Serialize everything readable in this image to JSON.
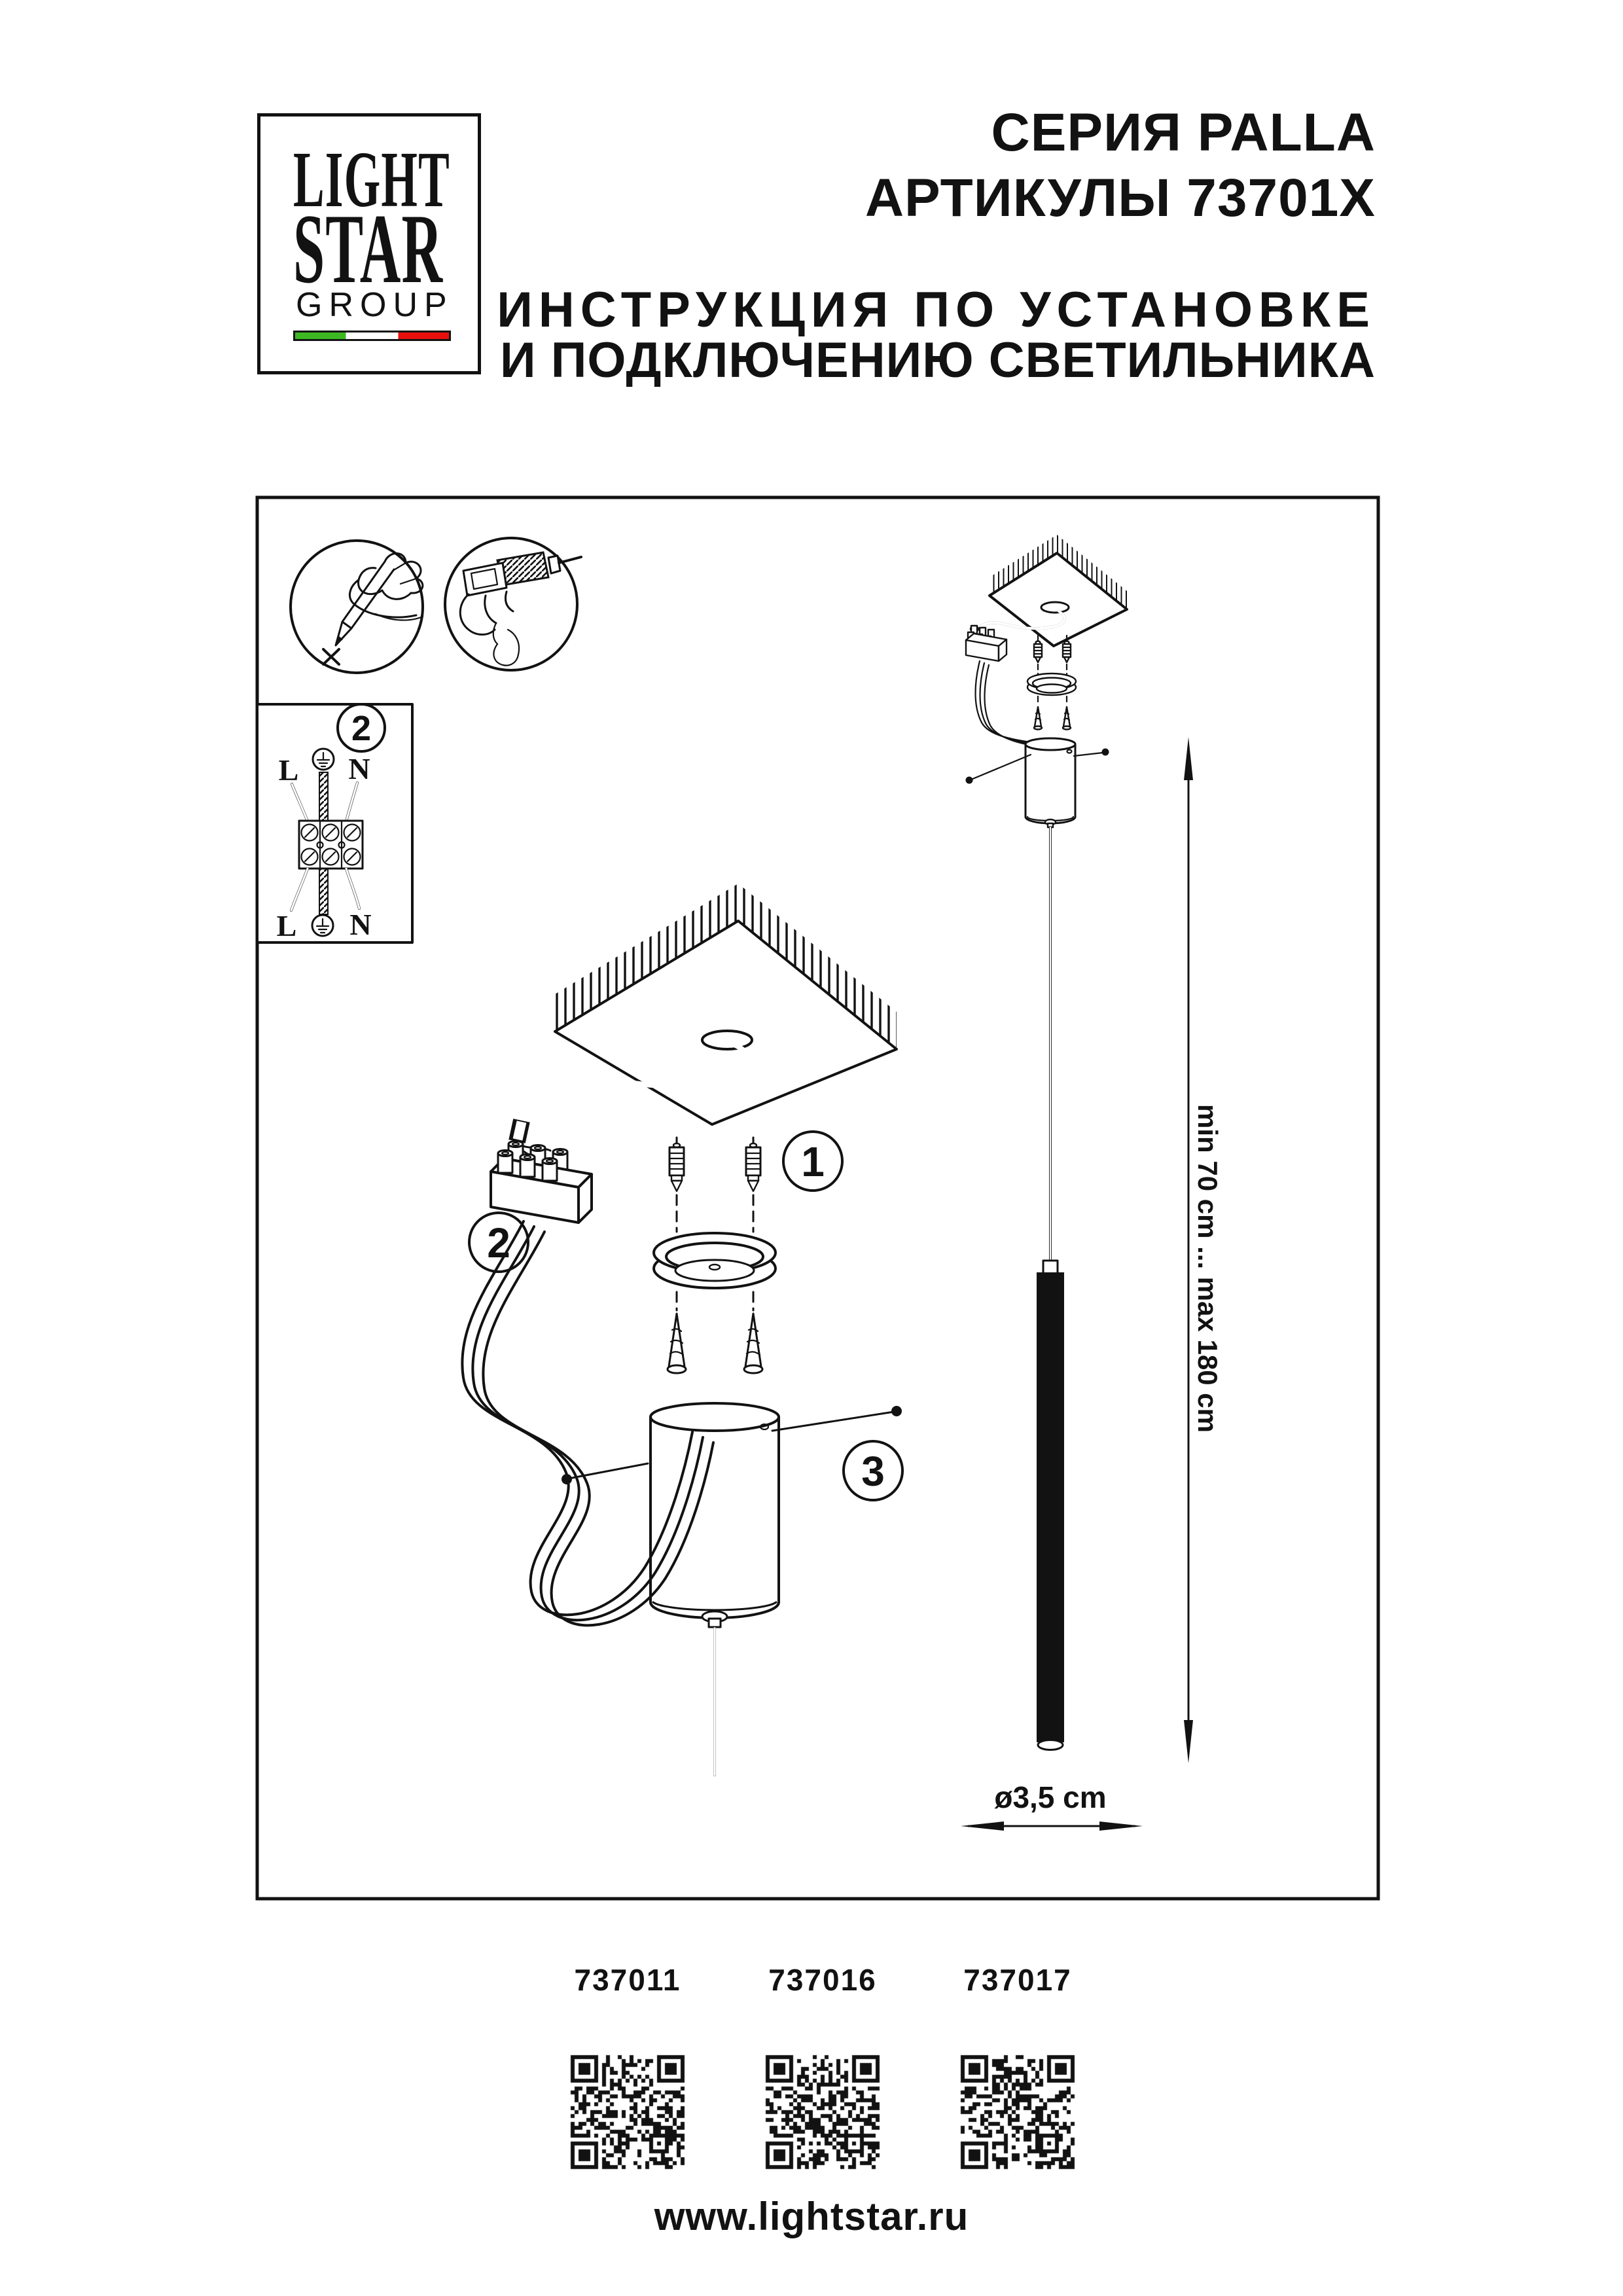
{
  "header": {
    "logo": {
      "line1": "LIGHT",
      "line2": "STAR",
      "line3": "GROUP",
      "flag": {
        "green": "#3db822",
        "white": "#ffffff",
        "red": "#e8100c"
      }
    },
    "series_line": "СЕРИЯ PALLA",
    "articles_line": "АРТИКУЛЫ 73701X",
    "instruction_line1": "ИНСТРУКЦИЯ ПО УСТАНОВКЕ",
    "instruction_line2": "И ПОДКЛЮЧЕНИЮ СВЕТИЛЬНИКА"
  },
  "diagram": {
    "labels": {
      "step1": "1",
      "step2": "2",
      "step2_box": "2",
      "step3": "3"
    },
    "wiring_box": {
      "top_left": "L",
      "top_right": "N",
      "bottom_left": "L",
      "bottom_right": "N"
    },
    "dimensions": {
      "suspension_range": "min 70 cm ... max 180 cm",
      "tube_diameter": "ø3,5 cm"
    }
  },
  "products": [
    {
      "article": "737011"
    },
    {
      "article": "737016"
    },
    {
      "article": "737017"
    }
  ],
  "footer": {
    "website": "www.lightstar.ru"
  }
}
